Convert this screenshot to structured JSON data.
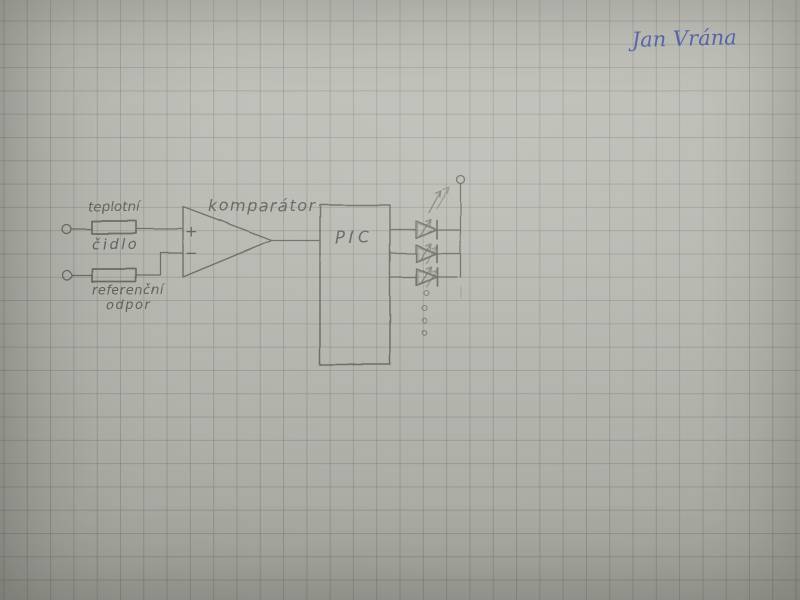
{
  "meta": {
    "description": "Photograph of a hand-drawn electronic circuit sketch in pencil on squared graph paper, signed in blue ink"
  },
  "signature": {
    "text": "Jan Vrána",
    "color": "#3c4da6"
  },
  "labels": {
    "sensor_line1": "teplotní",
    "sensor_line2": "čidlo",
    "reference_line1": "referenční",
    "reference_line2": "odpor",
    "comparator": "komparátor",
    "pic": "PIC",
    "plus_input": "+",
    "minus_input": "−"
  },
  "colors": {
    "paper": "#b9bbb3",
    "grid_line": "#9a9e96",
    "pencil": "#56544e",
    "ink_blue": "#3c4da6"
  },
  "diagram": {
    "type": "circuit-sketch",
    "components": [
      {
        "id": "input-terminal-top",
        "kind": "open terminal"
      },
      {
        "id": "temperature-sensor",
        "kind": "resistor",
        "label": "teplotní čidlo"
      },
      {
        "id": "input-terminal-bottom",
        "kind": "open terminal"
      },
      {
        "id": "reference-resistor",
        "kind": "resistor",
        "label": "referenční odpor"
      },
      {
        "id": "comparator",
        "kind": "op-amp comparator",
        "label": "komparátor",
        "inputs": [
          "+",
          "−"
        ]
      },
      {
        "id": "pic",
        "kind": "microcontroller box",
        "label": "PIC"
      },
      {
        "id": "led-1",
        "kind": "LED with emission arrows"
      },
      {
        "id": "led-2",
        "kind": "LED with emission arrows"
      },
      {
        "id": "led-3",
        "kind": "LED with emission arrows"
      },
      {
        "id": "led-ellipsis",
        "kind": "continuation dots",
        "count": 4
      },
      {
        "id": "output-terminal",
        "kind": "open terminal"
      }
    ],
    "connections": [
      "input-terminal-top → temperature-sensor → comparator:+",
      "input-terminal-bottom → reference-resistor → comparator:−",
      "comparator:out → pic",
      "pic → led-1 → led-bus",
      "pic → led-2 → led-bus",
      "pic → led-3 → led-bus",
      "led-bus → output-terminal"
    ]
  }
}
